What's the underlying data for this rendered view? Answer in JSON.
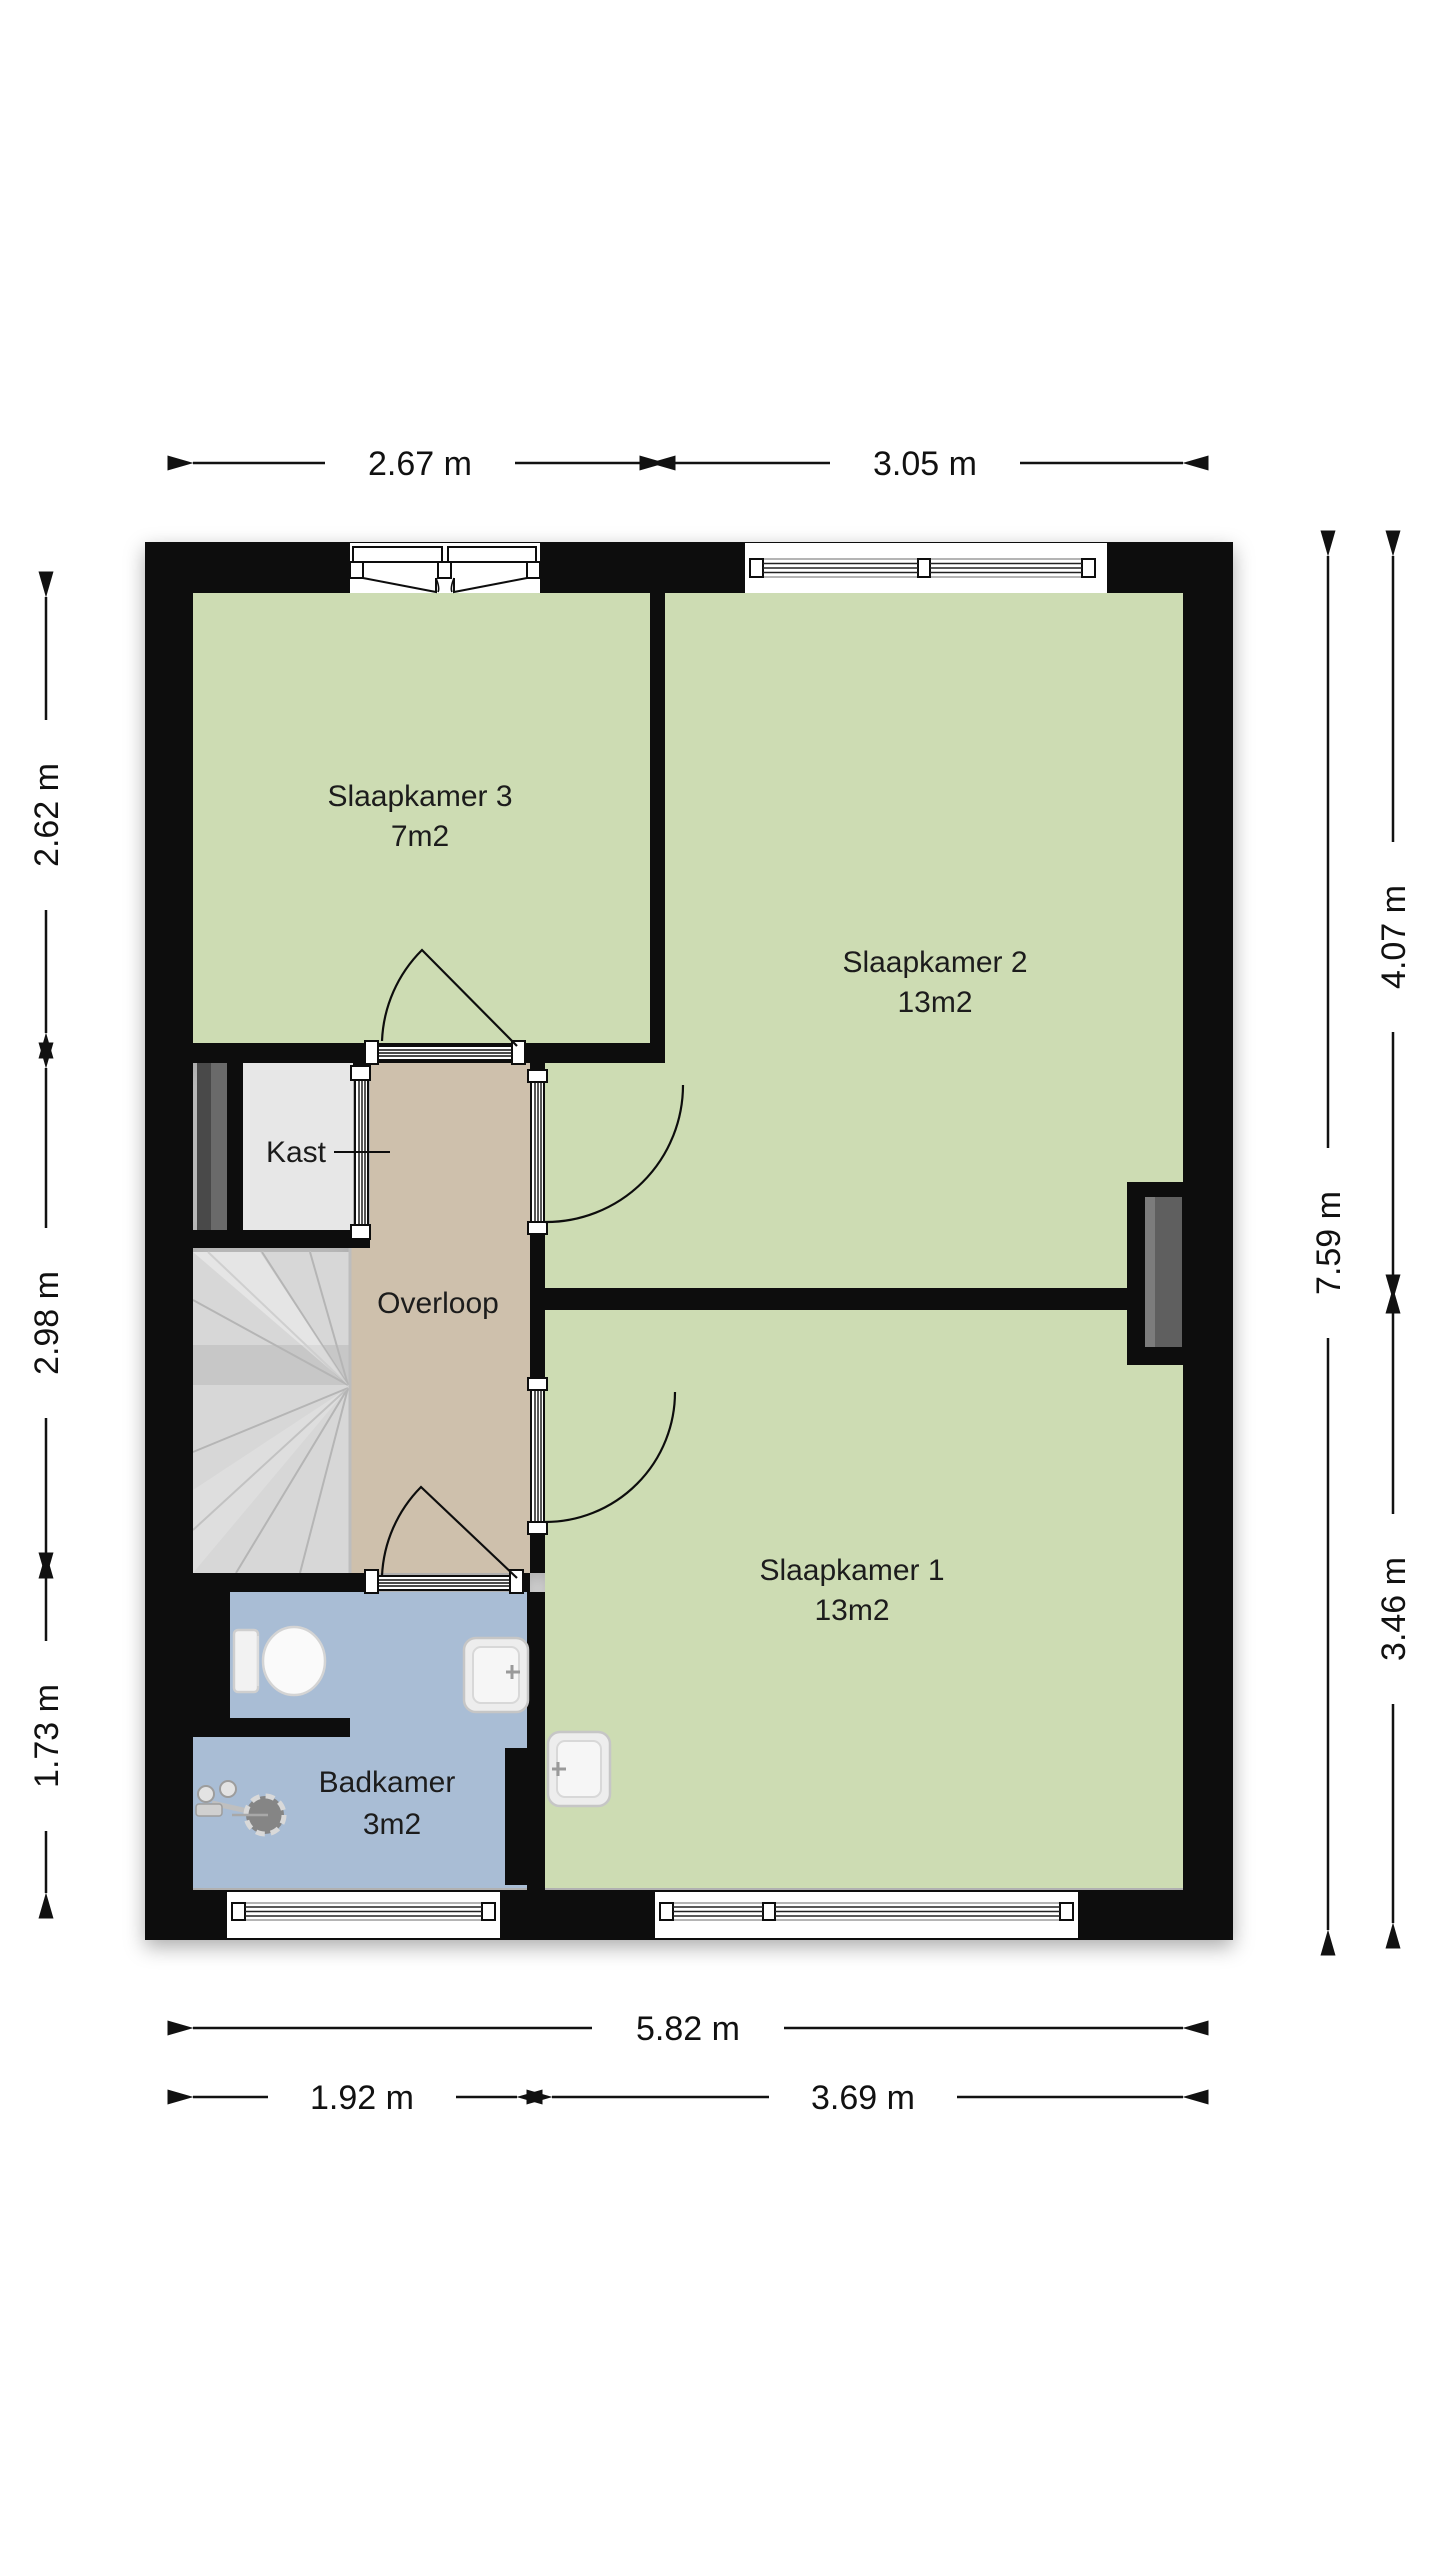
{
  "floorplan": {
    "rooms": [
      {
        "id": "slaapkamer3",
        "label": "Slaapkamer 3",
        "area": "7m2"
      },
      {
        "id": "slaapkamer2",
        "label": "Slaapkamer 2",
        "area": "13m2"
      },
      {
        "id": "slaapkamer1",
        "label": "Slaapkamer 1",
        "area": "13m2"
      },
      {
        "id": "badkamer",
        "label": "Badkamer",
        "area": "3m2"
      },
      {
        "id": "kast",
        "label": "Kast"
      },
      {
        "id": "overloop",
        "label": "Overloop"
      }
    ],
    "dims": {
      "top": [
        "2.67 m",
        "3.05 m"
      ],
      "left": [
        "2.62 m",
        "2.98 m",
        "1.73 m"
      ],
      "right": [
        "4.07 m",
        "7.59 m",
        "3.46 m"
      ],
      "bottom": [
        "5.82 m",
        "1.92 m",
        "3.69 m"
      ]
    },
    "colors": {
      "wall": "#0a0a0a",
      "room_green": "#cddcb3",
      "hall_tan": "#cec0ac",
      "bath_blue": "#a9bdd5",
      "closet_grey": "#e7e7e7",
      "stairs_grey": "#d7d7d7",
      "shaft_grey": "#4a4a4a",
      "recess_grey": "#5f5f5f"
    }
  }
}
